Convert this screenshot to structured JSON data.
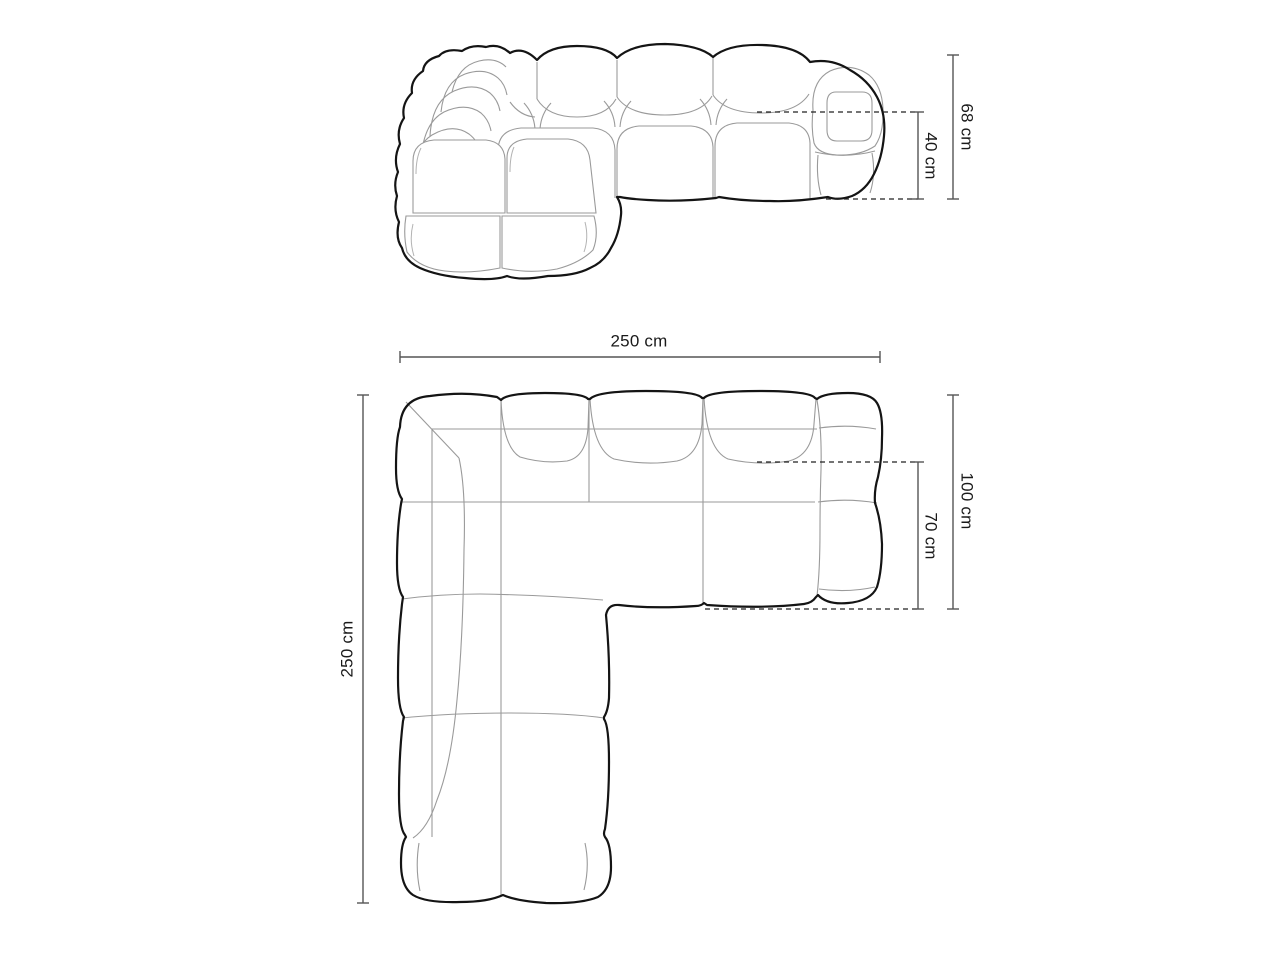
{
  "diagram": {
    "title": "Corner modular sofa dimension drawing",
    "views": {
      "elevation": {
        "name": "front elevation view",
        "dimensions": {
          "total_height": "68 cm",
          "seat_height": "40 cm"
        }
      },
      "plan": {
        "name": "top plan view",
        "dimensions": {
          "width": "250 cm",
          "length": "250 cm",
          "total_depth": "100 cm",
          "seat_depth": "70 cm"
        }
      }
    },
    "colors": {
      "background": "#ffffff",
      "outline": "#141414",
      "inner_line": "#9a9a9a",
      "dimension_line": "#555555",
      "dashed_line": "#222222",
      "label_text": "#1a1a1a"
    }
  }
}
